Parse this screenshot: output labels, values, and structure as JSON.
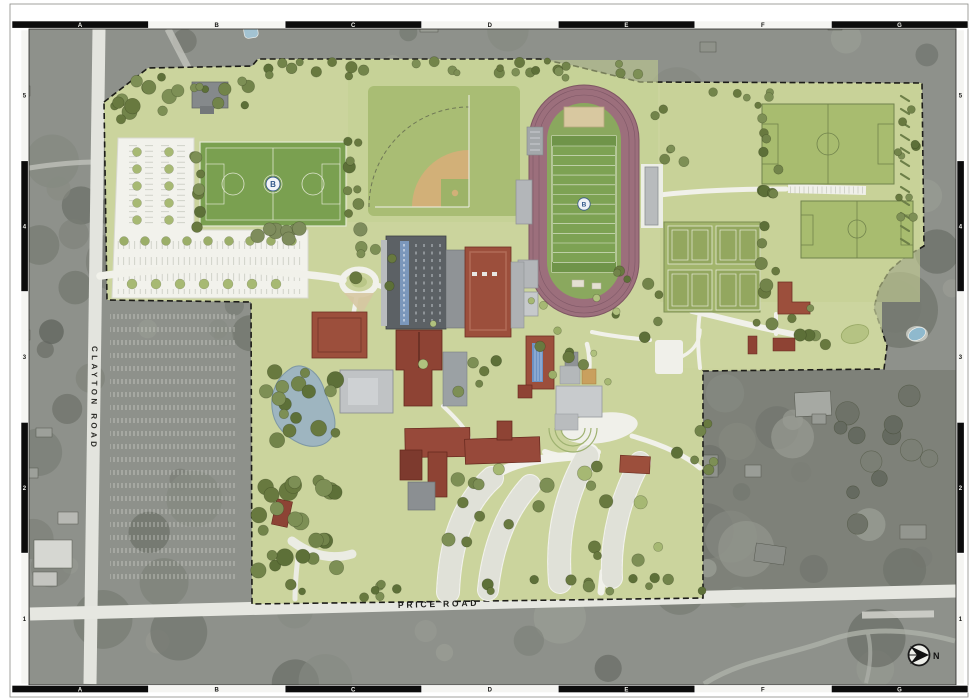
{
  "frame": {
    "top_letters": [
      "A",
      "B",
      "C",
      "D",
      "E",
      "F",
      "G"
    ],
    "bottom_letters": [
      "A",
      "B",
      "C",
      "D",
      "E",
      "F",
      "G"
    ],
    "left_numbers": [
      "5",
      "4",
      "3",
      "2",
      "1"
    ],
    "right_numbers": [
      "5",
      "4",
      "3",
      "2",
      "1"
    ]
  },
  "roads": {
    "west_road_label": "CLAYTON ROAD",
    "south_road_label": "PRICE ROAD"
  },
  "compass": {
    "north_label": "N"
  },
  "campus": {
    "turf_field_logo": "B",
    "football_field_logo": "B"
  },
  "colors": {
    "campus_green": "#cbd49d",
    "track_mauve": "#9c6f7c",
    "turf_green": "#7aa050",
    "field_green": "#a8bc6f",
    "roof_red": "#9c4f3c",
    "roof_gray": "#5c6165",
    "pond_blue": "#9eb5c0",
    "pavement_white": "#f1f1ea",
    "aerial_gray": "#8e918b"
  }
}
